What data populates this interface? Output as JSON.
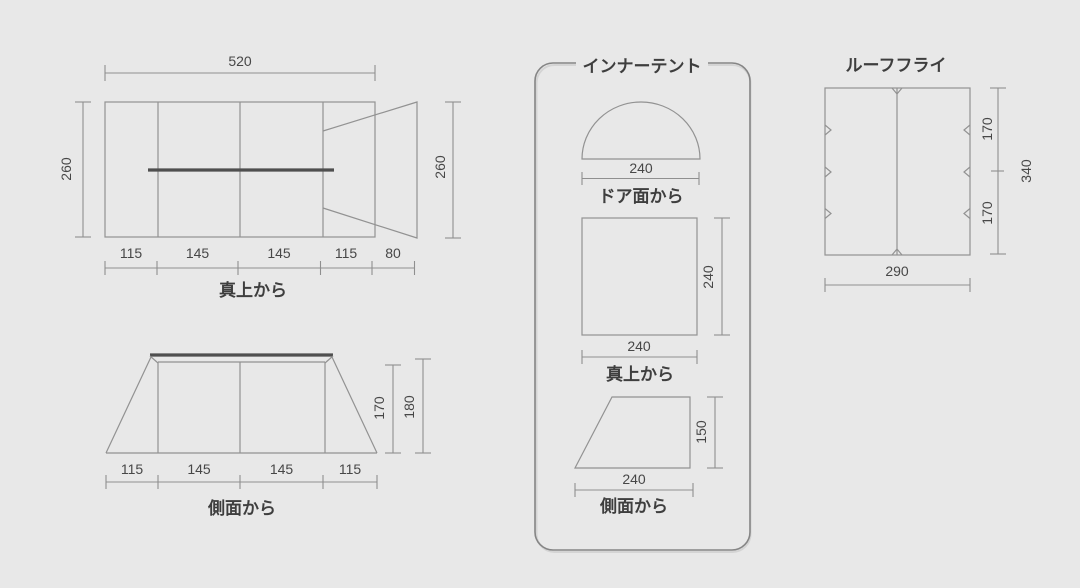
{
  "top_view": {
    "caption": "真上から",
    "width_label": "520",
    "height_left_label": "260",
    "height_right_label": "260",
    "segments": [
      "115",
      "145",
      "145",
      "115",
      "80"
    ]
  },
  "side_view": {
    "caption": "側面から",
    "inner_height_label": "170",
    "total_height_label": "180",
    "segments": [
      "115",
      "145",
      "145",
      "115"
    ]
  },
  "inner_tent": {
    "title": "インナーテント",
    "door_view": {
      "caption": "ドア面から",
      "width_label": "240"
    },
    "top_view": {
      "caption": "真上から",
      "width_label": "240",
      "depth_label": "240"
    },
    "side_view": {
      "caption": "側面から",
      "width_label": "240",
      "height_label": "150"
    }
  },
  "roof_fly": {
    "title": "ルーフフライ",
    "width_label": "290",
    "total_height_label": "340",
    "upper_height_label": "170",
    "lower_height_label": "170"
  },
  "colors": {
    "background": "#e8e8e8",
    "outline": "#929292",
    "pole": "#4f4f4f",
    "text": "#454545",
    "panel_border": "#858585"
  }
}
